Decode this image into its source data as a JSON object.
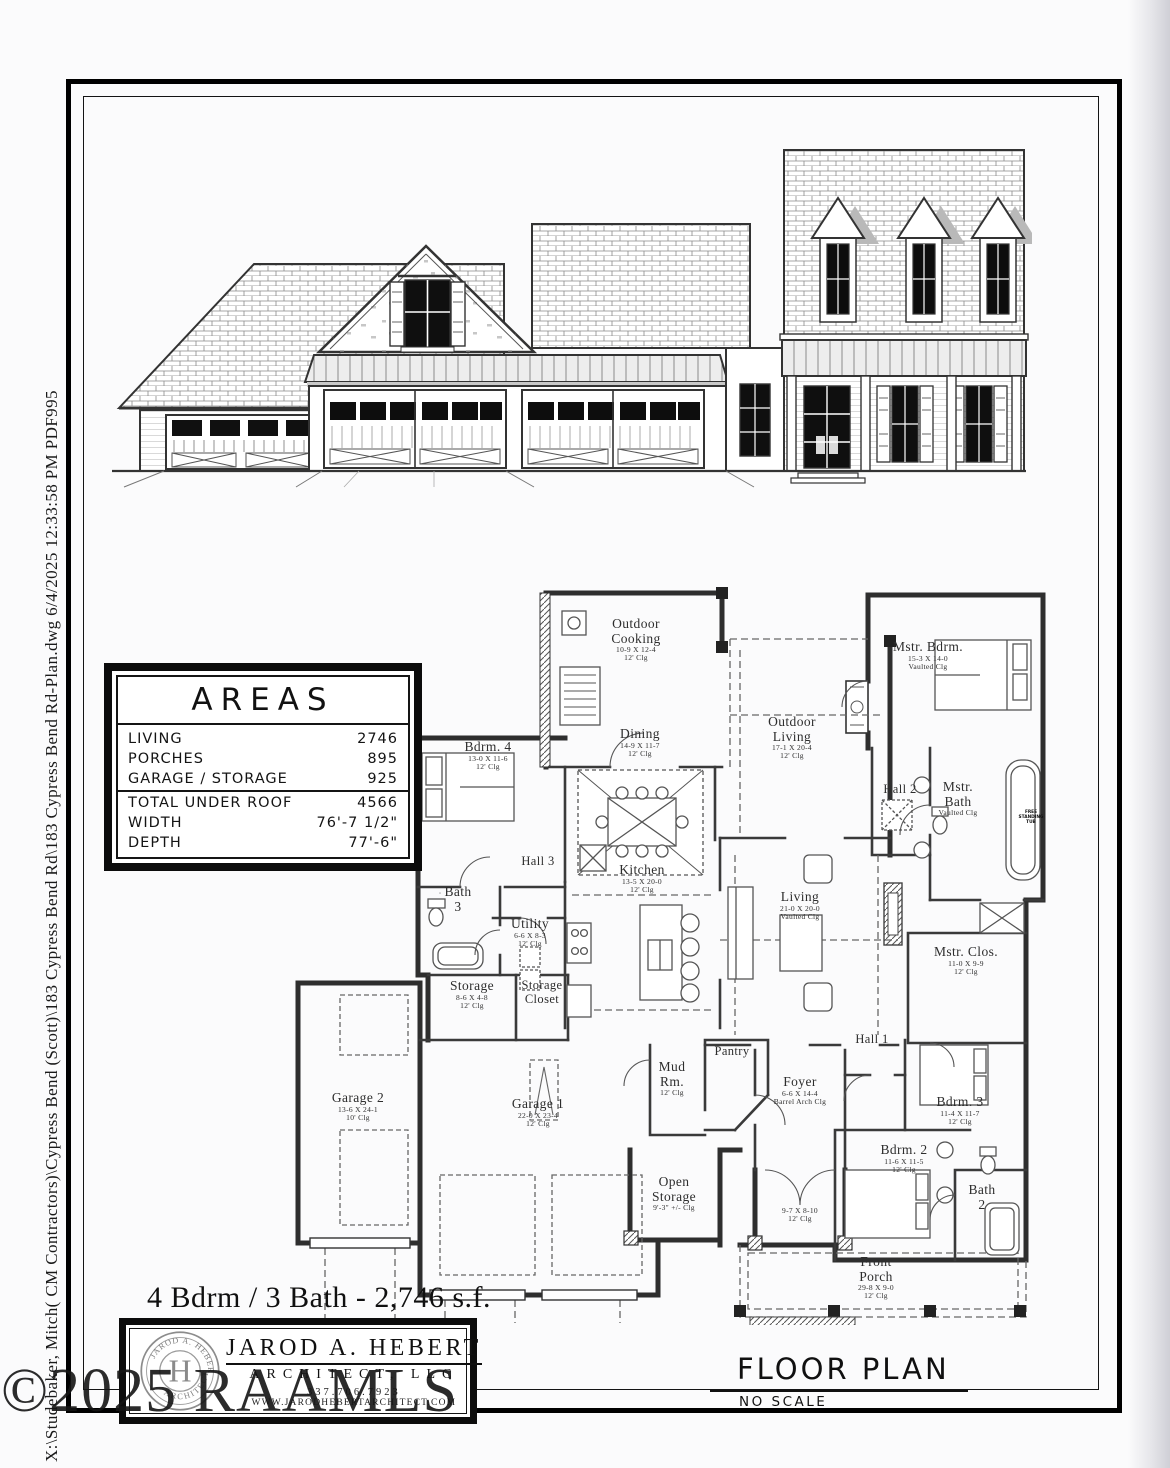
{
  "file_info": "X:\\Studebaker, Mitch( CM Contractors)\\Cypress Bend (Scott)\\183 Cypress Bend Rd\\183 Cypress Bend Rd-Plan.dwg  6/4/2025 12:33:58 PM  PDF995",
  "watermark": "©2025 RAAMLS",
  "summary_title": "4 Bdrm / 3 Bath - 2,746 s.f.",
  "floor_plan": {
    "title": "FLOOR PLAN",
    "scale": "NO SCALE"
  },
  "areas_table": {
    "title": "AREAS",
    "rows": [
      {
        "label": "LIVING",
        "value": "2746"
      },
      {
        "label": "PORCHES",
        "value": "895"
      },
      {
        "label": "GARAGE / STORAGE",
        "value": "925"
      },
      {
        "label": "TOTAL UNDER ROOF",
        "value": "4566"
      },
      {
        "label": "WIDTH",
        "value": "76'-7 1/2\""
      },
      {
        "label": "DEPTH",
        "value": "77'-6\""
      }
    ]
  },
  "architect": {
    "name": "JAROD A. HEBERT",
    "subtitle": "ARCHITECT, LLC",
    "phone": "337.706.7923",
    "website": "WWW.JARODHEBERTARCHITECT.COM",
    "seal_top": "JAROD A. HEBERT",
    "seal_bottom": "ARCHITECT",
    "seal_monogram": "H"
  },
  "annotations": {
    "tub": "FREE STANDING TUB"
  },
  "ink_color": "#2e2e2e",
  "rooms": [
    {
      "n1": "Outdoor",
      "n2": "Cooking",
      "dims": "10-9 X 12-4",
      "clg": "12' Clg"
    },
    {
      "n1": "Outdoor",
      "n2": "Living",
      "dims": "17-1 X 20-4",
      "clg": "12' Clg"
    },
    {
      "n1": "Mstr. Bdrm.",
      "n2": "",
      "dims": "15-3 X 14-0",
      "clg": "Vaulted Clg"
    },
    {
      "n1": "Bdrm. 4",
      "n2": "",
      "dims": "13-0 X 11-6",
      "clg": "12' Clg"
    },
    {
      "n1": "Dining",
      "n2": "",
      "dims": "14-9 X 11-7",
      "clg": "12' Clg"
    },
    {
      "n1": "Hall 2",
      "n2": "",
      "dims": "",
      "clg": ""
    },
    {
      "n1": "Mstr.",
      "n2": "Bath",
      "dims": "",
      "clg": "Vaulted Clg"
    },
    {
      "n1": "Bath",
      "n2": "3",
      "dims": "",
      "clg": ""
    },
    {
      "n1": "Hall 3",
      "n2": "",
      "dims": "",
      "clg": ""
    },
    {
      "n1": "Utility",
      "n2": "",
      "dims": "6-6 X 8-3",
      "clg": "12' Clg"
    },
    {
      "n1": "Kitchen",
      "n2": "",
      "dims": "13-5 X 20-0",
      "clg": "12' Clg"
    },
    {
      "n1": "Living",
      "n2": "",
      "dims": "21-0 X 20-0",
      "clg": "Vaulted Clg"
    },
    {
      "n1": "Mstr. Clos.",
      "n2": "",
      "dims": "11-0 X 9-9",
      "clg": "12' Clg"
    },
    {
      "n1": "Storage",
      "n2": "",
      "dims": "8-6 X 4-8",
      "clg": "12' Clg"
    },
    {
      "n1": "Storage",
      "n2": "Closet",
      "dims": "",
      "clg": ""
    },
    {
      "n1": "Garage 2",
      "n2": "",
      "dims": "13-6 X 24-1",
      "clg": "10' Clg"
    },
    {
      "n1": "Garage 1",
      "n2": "",
      "dims": "22-0 X 23-4",
      "clg": "12' Clg"
    },
    {
      "n1": "Mud",
      "n2": "Rm.",
      "dims": "",
      "clg": "12' Clg"
    },
    {
      "n1": "Pantry",
      "n2": "",
      "dims": "",
      "clg": ""
    },
    {
      "n1": "Foyer",
      "n2": "",
      "dims": "6-6 X 14-4",
      "clg": "Barrel Arch Clg"
    },
    {
      "n1": "Hall 1",
      "n2": "",
      "dims": "",
      "clg": ""
    },
    {
      "n1": "Open",
      "n2": "Storage",
      "dims": "",
      "clg": "9'-3\" +/- Clg"
    },
    {
      "n1": "Bdrm. 2",
      "n2": "",
      "dims": "11-6 X 11-5",
      "clg": "12' Clg"
    },
    {
      "n1": "Bdrm. 3",
      "n2": "",
      "dims": "11-4 X 11-7",
      "clg": "12' Clg"
    },
    {
      "n1": "Bath",
      "n2": "2",
      "dims": "",
      "clg": ""
    },
    {
      "n1": "",
      "n2": "",
      "dims": "9-7 X 8-10",
      "clg": "12' Clg"
    },
    {
      "n1": "Front",
      "n2": "Porch",
      "dims": "29-8 X 9-0",
      "clg": "12' Clg"
    }
  ]
}
